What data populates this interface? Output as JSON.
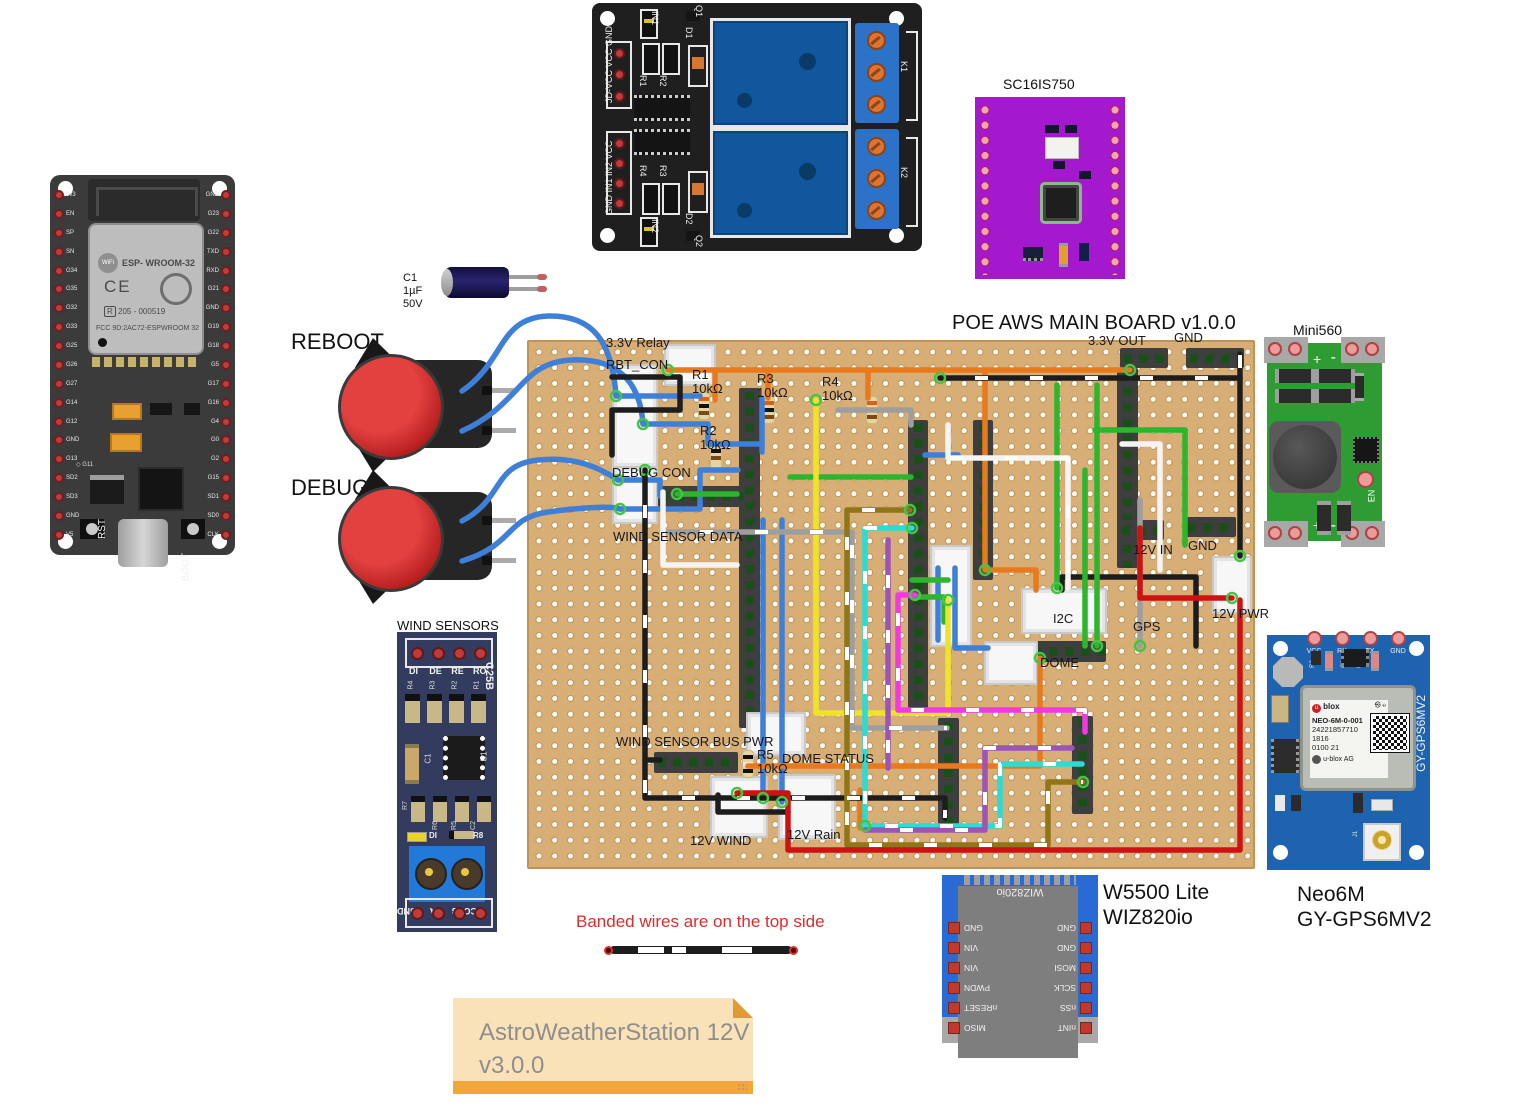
{
  "title": "POE AWS MAIN BOARD v1.0.0",
  "note": {
    "line1": "AstroWeatherStation 12V",
    "line2": "v3.0.0"
  },
  "banded_note": "Banded wires are on the top side",
  "buttons": {
    "reboot": "REBOOT",
    "debug": "DEBUG"
  },
  "cap": {
    "ref": "C1",
    "value": "1µF",
    "voltage": "50V"
  },
  "esp32": {
    "left_pins": [
      "3v3",
      "EN",
      "SP",
      "SN",
      "G34",
      "G35",
      "G32",
      "G33",
      "G25",
      "G26",
      "G27",
      "G14",
      "G12",
      "GND",
      "G13",
      "SD2",
      "SD3",
      "GND",
      "V5"
    ],
    "right_pins": [
      "GND",
      "G23",
      "G22",
      "TXD",
      "RXD",
      "G21",
      "GND",
      "G19",
      "G18",
      "G5",
      "G17",
      "G16",
      "G4",
      "G0",
      "G2",
      "G15",
      "SD1",
      "SD0",
      "CLK"
    ],
    "wifi": "WiFi",
    "module": "ESP- WROOM-32",
    "ce": "CE",
    "cert": "205 - 000519",
    "fcc": "FCC 9D:2AC72-ESPWROOM 32",
    "g11": "◇ G11",
    "rst": "RST",
    "boot": "BOOT"
  },
  "relay": {
    "top_header": [
      "JD-VCC",
      "VCC",
      "GND"
    ],
    "bottom_header": [
      "GND",
      "IN1",
      "IN2",
      "VCC"
    ],
    "refs": {
      "in1": "IN1",
      "in2": "IN2",
      "r1": "R1",
      "r2": "R2",
      "r3": "R3",
      "r4": "R4",
      "d1": "D1",
      "d2": "D2",
      "q1": "Q1",
      "q2": "Q2",
      "k1": "K1",
      "k2": "K2"
    }
  },
  "sc16is750": {
    "title": "SC16IS750"
  },
  "mini560": {
    "title": "Mini560",
    "en": "EN",
    "plus": "+",
    "minus": "-"
  },
  "gps": {
    "caption1": "Neo6M",
    "caption2": "GY-GPS6MV2",
    "side": "GY-GPS6MV2",
    "pins": [
      "VCC",
      "RX",
      "TX",
      "GND"
    ],
    "refs": [
      "R3",
      "D2",
      "C2",
      "U2",
      "C1"
    ],
    "brand": "blox",
    "module_lines": [
      "NEO-6M-0-001",
      "24221857710",
      "1816",
      "0100 21"
    ],
    "agency": "u-blox AG",
    "j1": "J1"
  },
  "w5500": {
    "caption1": "W5500 Lite",
    "caption2": "WIZ820io",
    "module_text": "WIZ820io",
    "left_pins": [
      "MISO",
      "nRESET",
      "PWDN",
      "VIN",
      "VIN",
      "GND"
    ],
    "right_pins": [
      "nINT",
      "nSS",
      "SCLK",
      "MOSI",
      "GND",
      "GND"
    ]
  },
  "wind": {
    "title": "WIND SENSORS",
    "side": "C25B",
    "top_pins": [
      "DI",
      "DE",
      "RE",
      "RO"
    ],
    "top_res": [
      "R4",
      "R3",
      "R2",
      "R1"
    ],
    "mid_refs": {
      "c1": "C1",
      "u1": "U1"
    },
    "low_refs": [
      "R7",
      "R6",
      "R5",
      "C2",
      "R8"
    ],
    "led": "DI",
    "bottom_pins": [
      "VCC",
      "B",
      "A",
      "GND"
    ]
  },
  "board_labels": [
    {
      "t": "3.3V Relay",
      "x": 606,
      "y": 336
    },
    {
      "t": "RBT_CON",
      "x": 606,
      "y": 358
    },
    {
      "t": "R1",
      "x": 692,
      "y": 368
    },
    {
      "t": "10kΩ",
      "x": 692,
      "y": 382
    },
    {
      "t": "R3",
      "x": 757,
      "y": 372
    },
    {
      "t": "10kΩ",
      "x": 757,
      "y": 386
    },
    {
      "t": "R4",
      "x": 822,
      "y": 375
    },
    {
      "t": "10kΩ",
      "x": 822,
      "y": 389
    },
    {
      "t": "R2",
      "x": 700,
      "y": 424
    },
    {
      "t": "10kΩ",
      "x": 700,
      "y": 438
    },
    {
      "t": "DEBUG CON",
      "x": 612,
      "y": 466
    },
    {
      "t": "WIND SENSOR DATA",
      "x": 613,
      "y": 530
    },
    {
      "t": "WIND SENSOR BUS PWR",
      "x": 616,
      "y": 735
    },
    {
      "t": "R5",
      "x": 757,
      "y": 748
    },
    {
      "t": "10kΩ",
      "x": 757,
      "y": 762
    },
    {
      "t": "DOME STATUS",
      "x": 782,
      "y": 752
    },
    {
      "t": "12V WIND",
      "x": 690,
      "y": 834
    },
    {
      "t": "12V Rain",
      "x": 787,
      "y": 828
    },
    {
      "t": "3.3V OUT",
      "x": 1088,
      "y": 334
    },
    {
      "t": "GND",
      "x": 1174,
      "y": 331
    },
    {
      "t": "12V IN",
      "x": 1133,
      "y": 543
    },
    {
      "t": "GND",
      "x": 1188,
      "y": 539
    },
    {
      "t": "12V PWR",
      "x": 1212,
      "y": 607
    },
    {
      "t": "I2C",
      "x": 1053,
      "y": 612
    },
    {
      "t": "GPS",
      "x": 1133,
      "y": 620
    },
    {
      "t": "DOME",
      "x": 1040,
      "y": 656
    }
  ],
  "colors": {
    "breadboard": "#D8AE77",
    "wire_blue": "#3E7FD8",
    "wire_orange": "#E87A1E",
    "wire_black": "#1D1D1D",
    "wire_green": "#2DB52D",
    "wire_yellow": "#EFE32A",
    "wire_gray": "#9E9E9E",
    "wire_white": "#F4F4F4",
    "wire_cyan": "#2BDCD4",
    "wire_magenta": "#F238E0",
    "wire_purple": "#9C55B5",
    "wire_olive": "#8F7618",
    "wire_red": "#CE1212",
    "relay_blue": "#11579E",
    "purple_board": "#A519CE",
    "mini_green": "#2E9B33",
    "gps_blue": "#1E63B0",
    "note_bg": "#FAE2B8",
    "note_bar": "#F2A73B",
    "banded_text": "#E02B2B"
  }
}
